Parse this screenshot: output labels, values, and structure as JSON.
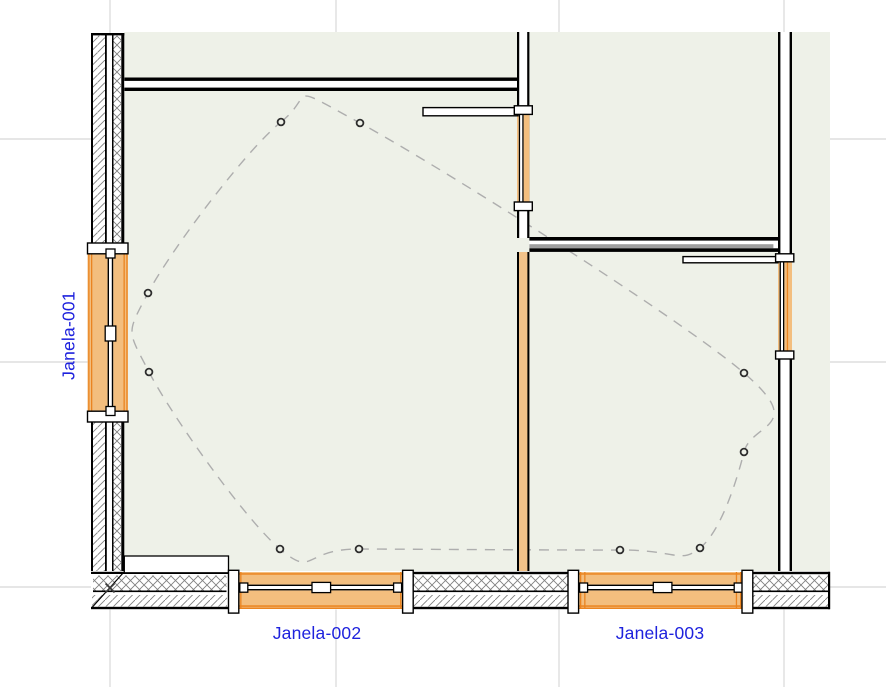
{
  "view": {
    "type": "floor-plan",
    "description": "CAD floor plan viewport with three labeled windows"
  },
  "labels": {
    "window1": "Janela-001",
    "window2": "Janela-002",
    "window3": "Janela-003"
  },
  "windows": [
    {
      "id": "Janela-001",
      "wall": "left-exterior",
      "orientation": "vertical"
    },
    {
      "id": "Janela-002",
      "wall": "bottom-exterior",
      "orientation": "horizontal"
    },
    {
      "id": "Janela-003",
      "wall": "bottom-exterior",
      "orientation": "horizontal"
    },
    {
      "id": "unlabeled-opening-interior",
      "wall": "vertical-interior",
      "orientation": "vertical"
    },
    {
      "id": "unlabeled-opening-right",
      "wall": "right-exterior",
      "orientation": "vertical"
    }
  ],
  "colors": {
    "zone": "#eef1e8",
    "grid": "#d8d8d8",
    "wall_line": "#000000",
    "hatch": "#808080",
    "window_fill": "#f3be7e",
    "window_fill_light": "#f2c289",
    "window_edge": "#ea8420",
    "gray_band": "#9d9d9d",
    "dash": "#aeaeae",
    "marker_ring": "#2d2d2d",
    "label_blue": "#1e22dd"
  },
  "grid": {
    "vertical_x": [
      110,
      336,
      559,
      784
    ],
    "horizontal_y": [
      139,
      362,
      587
    ],
    "origin_marker": {
      "x": 110,
      "y": 588
    }
  },
  "spline": {
    "closed": true,
    "points": [
      [
        281,
        122
      ],
      [
        360,
        123
      ],
      [
        744,
        373
      ],
      [
        744,
        452
      ],
      [
        700,
        548
      ],
      [
        620,
        550
      ],
      [
        359,
        549
      ],
      [
        280,
        549
      ],
      [
        149,
        372
      ],
      [
        148,
        293
      ]
    ]
  }
}
